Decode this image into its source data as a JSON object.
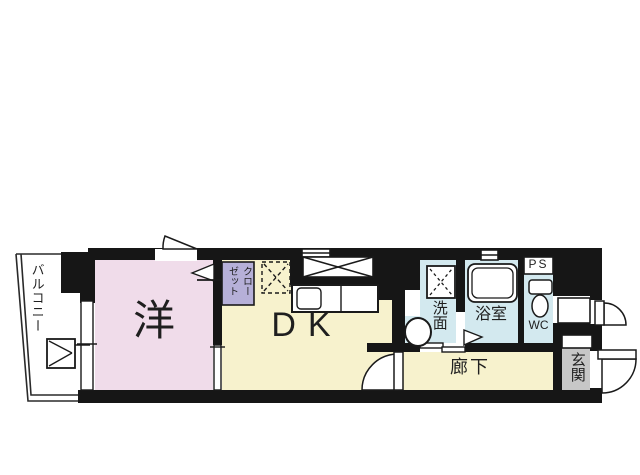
{
  "title": "apartment floor plan",
  "colors": {
    "wall": "#161616",
    "room_pink": "#f0dcea",
    "room_yellow": "#f7f2cd",
    "room_blue": "#d3e9ef",
    "closet_purple": "#b6b0d8",
    "entrance_gray": "#c7c7c7",
    "line": "#1a1a1a"
  },
  "labels": {
    "balcony": "バルコニー",
    "western_room": "洋",
    "closet_col_right": "クロー",
    "closet_col_left": "ゼット",
    "dining_kitchen": "DK",
    "washroom": "洗面",
    "bathroom": "浴室",
    "pipe_space": "PS",
    "toilet": "WC",
    "corridor": "廊下",
    "entrance": "玄関"
  }
}
